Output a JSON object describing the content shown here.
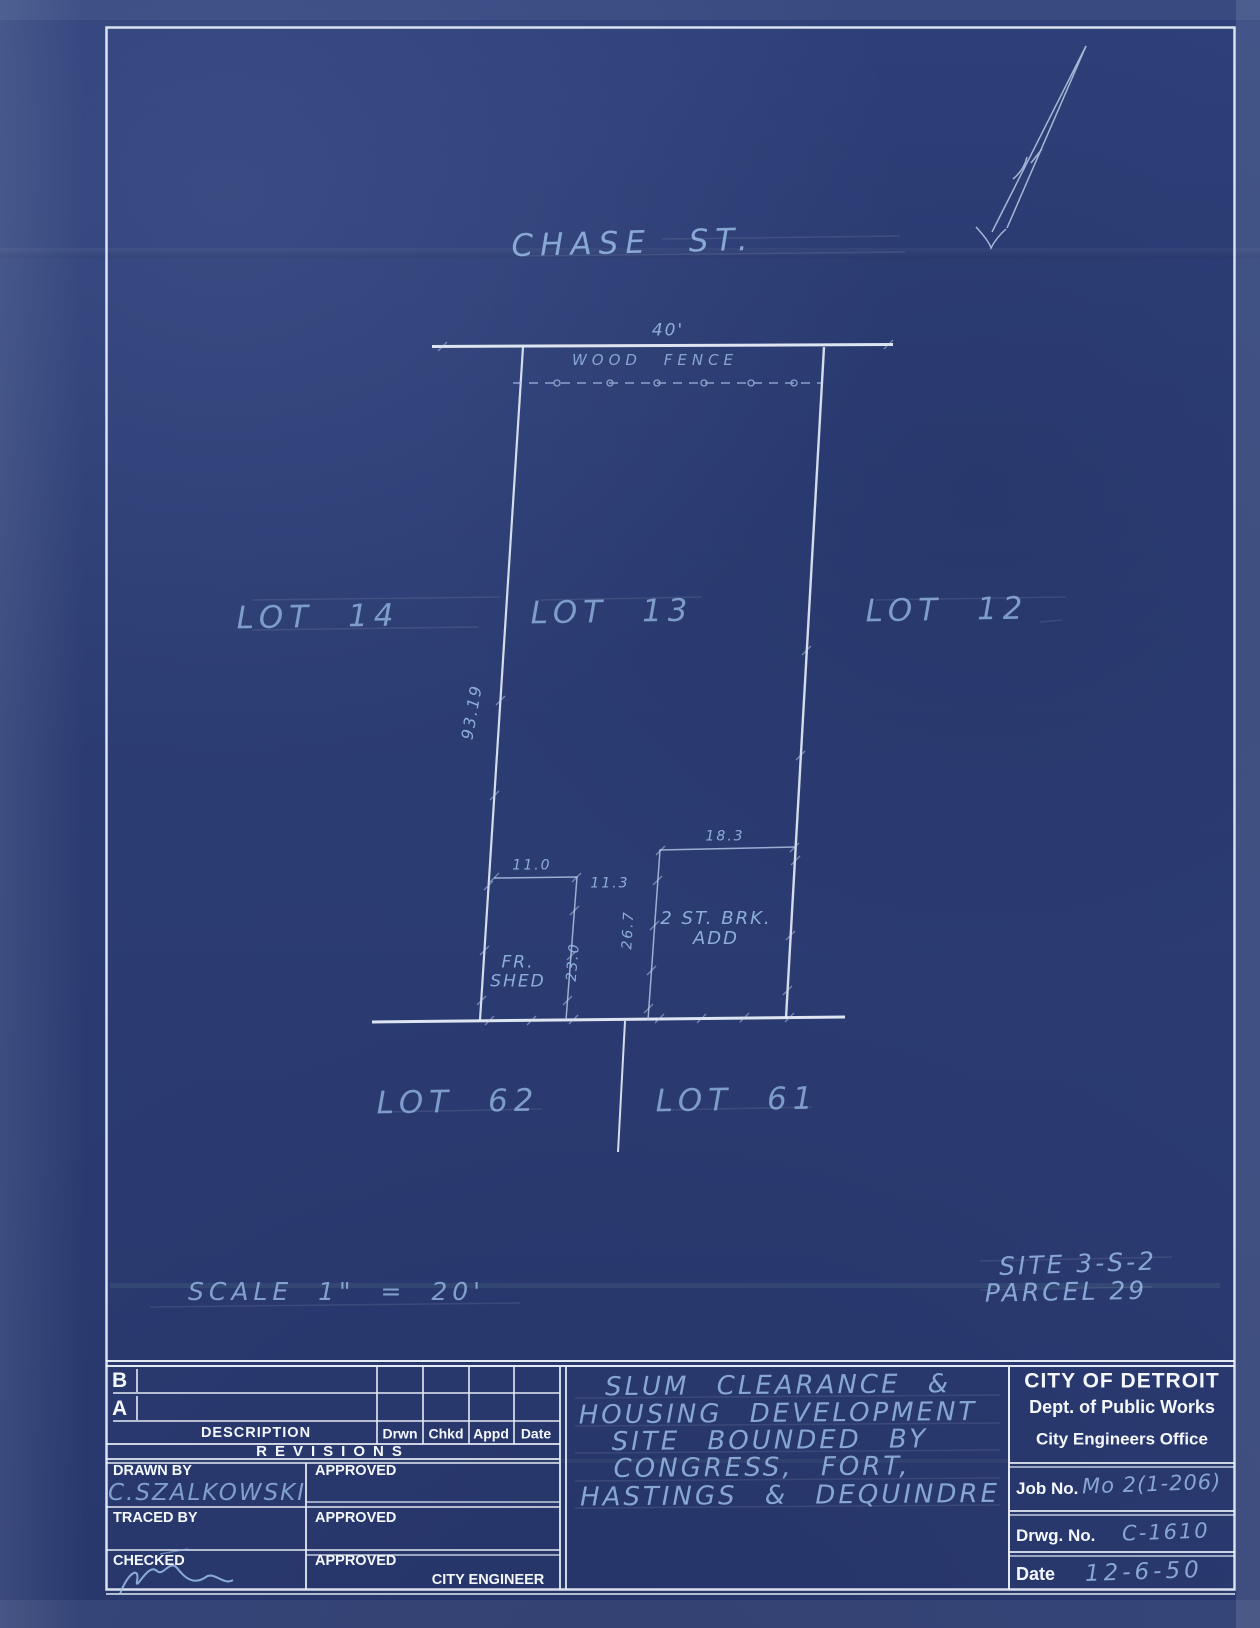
{
  "drawing": {
    "street_name": "CHASE ST.",
    "lots": [
      "LOT 14",
      "LOT 13",
      "LOT 12",
      "LOT 62",
      "LOT 61"
    ],
    "wood_fence_label": "WOOD FENCE",
    "dimensions": {
      "frontage": "40'",
      "west_depth": "93.19",
      "shed_width": "11.0",
      "shed_depth": "23.0",
      "shed_to_addition_gap": "11.3",
      "addition_width": "18.3",
      "addition_depth": "26.7"
    },
    "structures": {
      "shed_line1": "FR.",
      "shed_line2": "SHED",
      "addition_line1": "2 ST. BRK.",
      "addition_line2": "ADD"
    },
    "scale_note": "SCALE 1\" = 20'",
    "site_ref": "SITE 3-S-2",
    "parcel_ref": "PARCEL 29"
  },
  "title_block": {
    "revisions": {
      "row_b": "B",
      "row_a": "A",
      "col_description": "DESCRIPTION",
      "col_drwn": "Drwn",
      "col_chkd": "Chkd",
      "col_appd": "Appd",
      "col_date": "Date",
      "caption": "REVISIONS"
    },
    "signoff": {
      "drawn_by_label": "DRAWN BY",
      "drawn_by_value": "C.SZALKOWSKI",
      "traced_by_label": "TRACED BY",
      "checked_label": "CHECKED",
      "approved_label": "APPROVED",
      "city_engineer": "CITY ENGINEER"
    },
    "project_title": [
      "SLUM CLEARANCE &",
      "HOUSING DEVELOPMENT",
      "SITE BOUNDED BY",
      "CONGRESS, FORT,",
      "HASTINGS & DEQUINDRE"
    ],
    "agency": {
      "name": "CITY OF DETROIT",
      "department": "Dept. of Public Works",
      "office": "City Engineers Office"
    },
    "fields": {
      "job_no_label": "Job No.",
      "job_no_value": "Mo 2(1-206)",
      "drwg_no_label": "Drwg. No.",
      "drwg_no_value": "C-1610",
      "date_label": "Date",
      "date_value": "12-6-50"
    }
  },
  "colors": {
    "paper_blue": "#2b3c73",
    "line_white": "#e9f0f8",
    "hand_blue": "#9fc2ec"
  }
}
